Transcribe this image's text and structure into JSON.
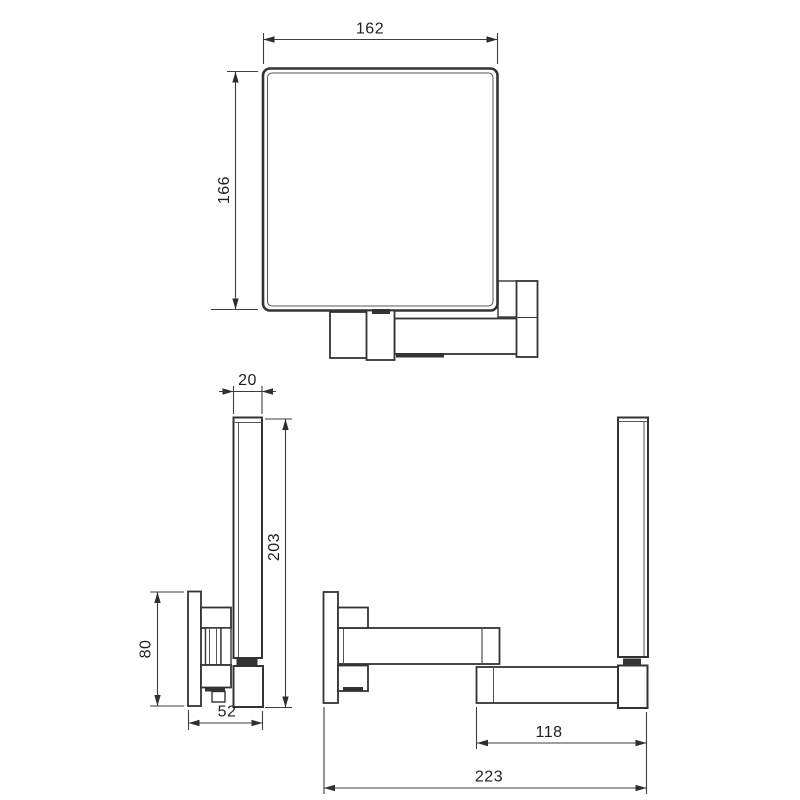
{
  "drawing": {
    "type": "technical-dimension-drawing",
    "views": {
      "front": {
        "dims": {
          "width": "162",
          "height": "166"
        }
      },
      "side_folded": {
        "dims": {
          "profile_thickness": "20",
          "overall_height": "203",
          "plate_height": "80",
          "folded_depth": "52"
        }
      },
      "side_extended": {
        "dims": {
          "arm_reach": "118",
          "overall_depth": "223"
        }
      }
    },
    "colors": {
      "background": "#ffffff",
      "object_line": "#333333",
      "dimension_line": "#3d3d3d",
      "text": "#1f1f1f",
      "shadow_band": "#333333"
    }
  }
}
